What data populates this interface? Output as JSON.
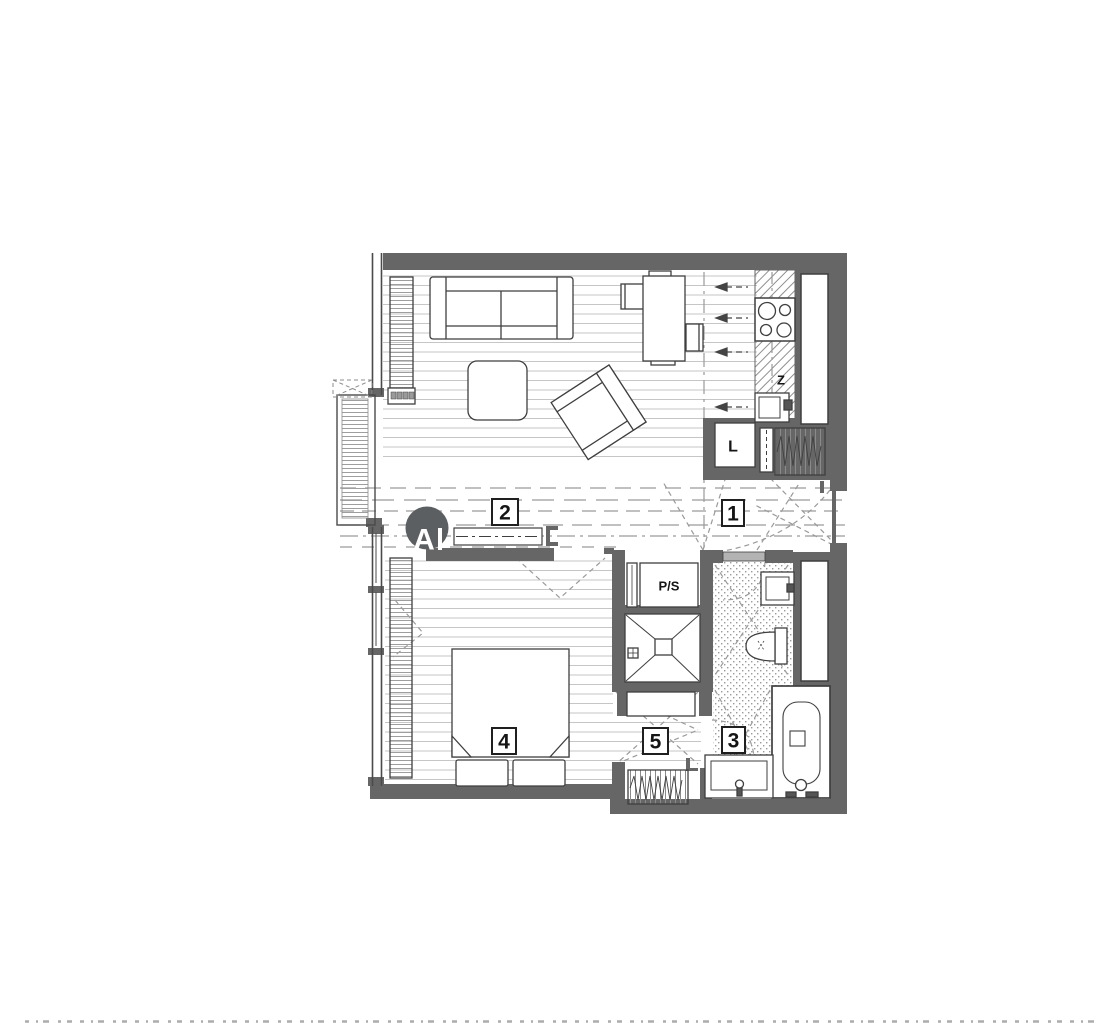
{
  "figure": {
    "type": "architectural apartment floor plan",
    "background": "#ffffff"
  },
  "room_labels": {
    "living_kitchen": "2",
    "hallway": "1",
    "bathroom": "3",
    "bedroom": "4",
    "corridor": "5"
  },
  "annotations": {
    "section_marker": "A",
    "closet_label": "L",
    "kitchen_counter_label": "Z",
    "washer_dryer_label": "P/S"
  },
  "colors": {
    "wall": "#666666",
    "floor_line": "#c6c6c6",
    "hatch_line": "#9e9e9e",
    "dash_line": "#9a9a9a",
    "furniture_outline": "#3f3f3f",
    "label_border": "#1f1f1f",
    "section_marker_fill": "#5b5f61",
    "door_leaf": "#b3b3b3",
    "background": "#ffffff"
  }
}
